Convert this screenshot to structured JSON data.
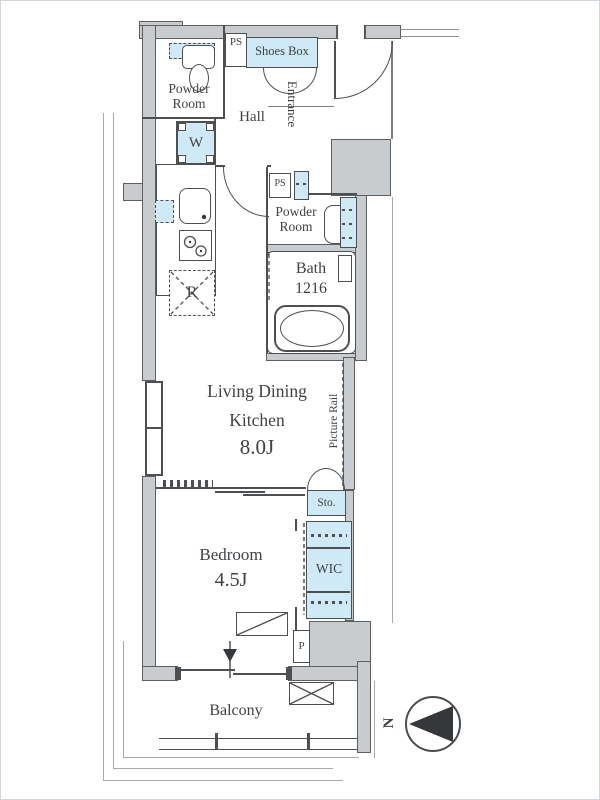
{
  "plan": {
    "powder_room_top": {
      "line1": "Powder",
      "line2": "Room"
    },
    "ps_top": "PS",
    "shoes_box": "Shoes Box",
    "hall": "Hall",
    "entrance": "Entrance",
    "washer": "W",
    "ps_mid": "PS",
    "powder_room_mid": {
      "line1": "Powder",
      "line2": "Room"
    },
    "bath": {
      "line1": "Bath",
      "line2": "1216"
    },
    "fridge": "R",
    "ldk": {
      "line1": "Living Dining",
      "line2": "Kitchen",
      "size": "8.0J"
    },
    "picture_rail": "Picture Rail",
    "storage": "Sto.",
    "wic": "WIC",
    "bedroom": {
      "name": "Bedroom",
      "size": "4.5J"
    },
    "pipe_space": "P",
    "balcony": "Balcony",
    "compass_north": "N"
  },
  "colors": {
    "wall_fill": "#c9ccce",
    "outline": "#4d5052",
    "fixture_blue": "#cfe9f6",
    "text": "#3f4245"
  }
}
